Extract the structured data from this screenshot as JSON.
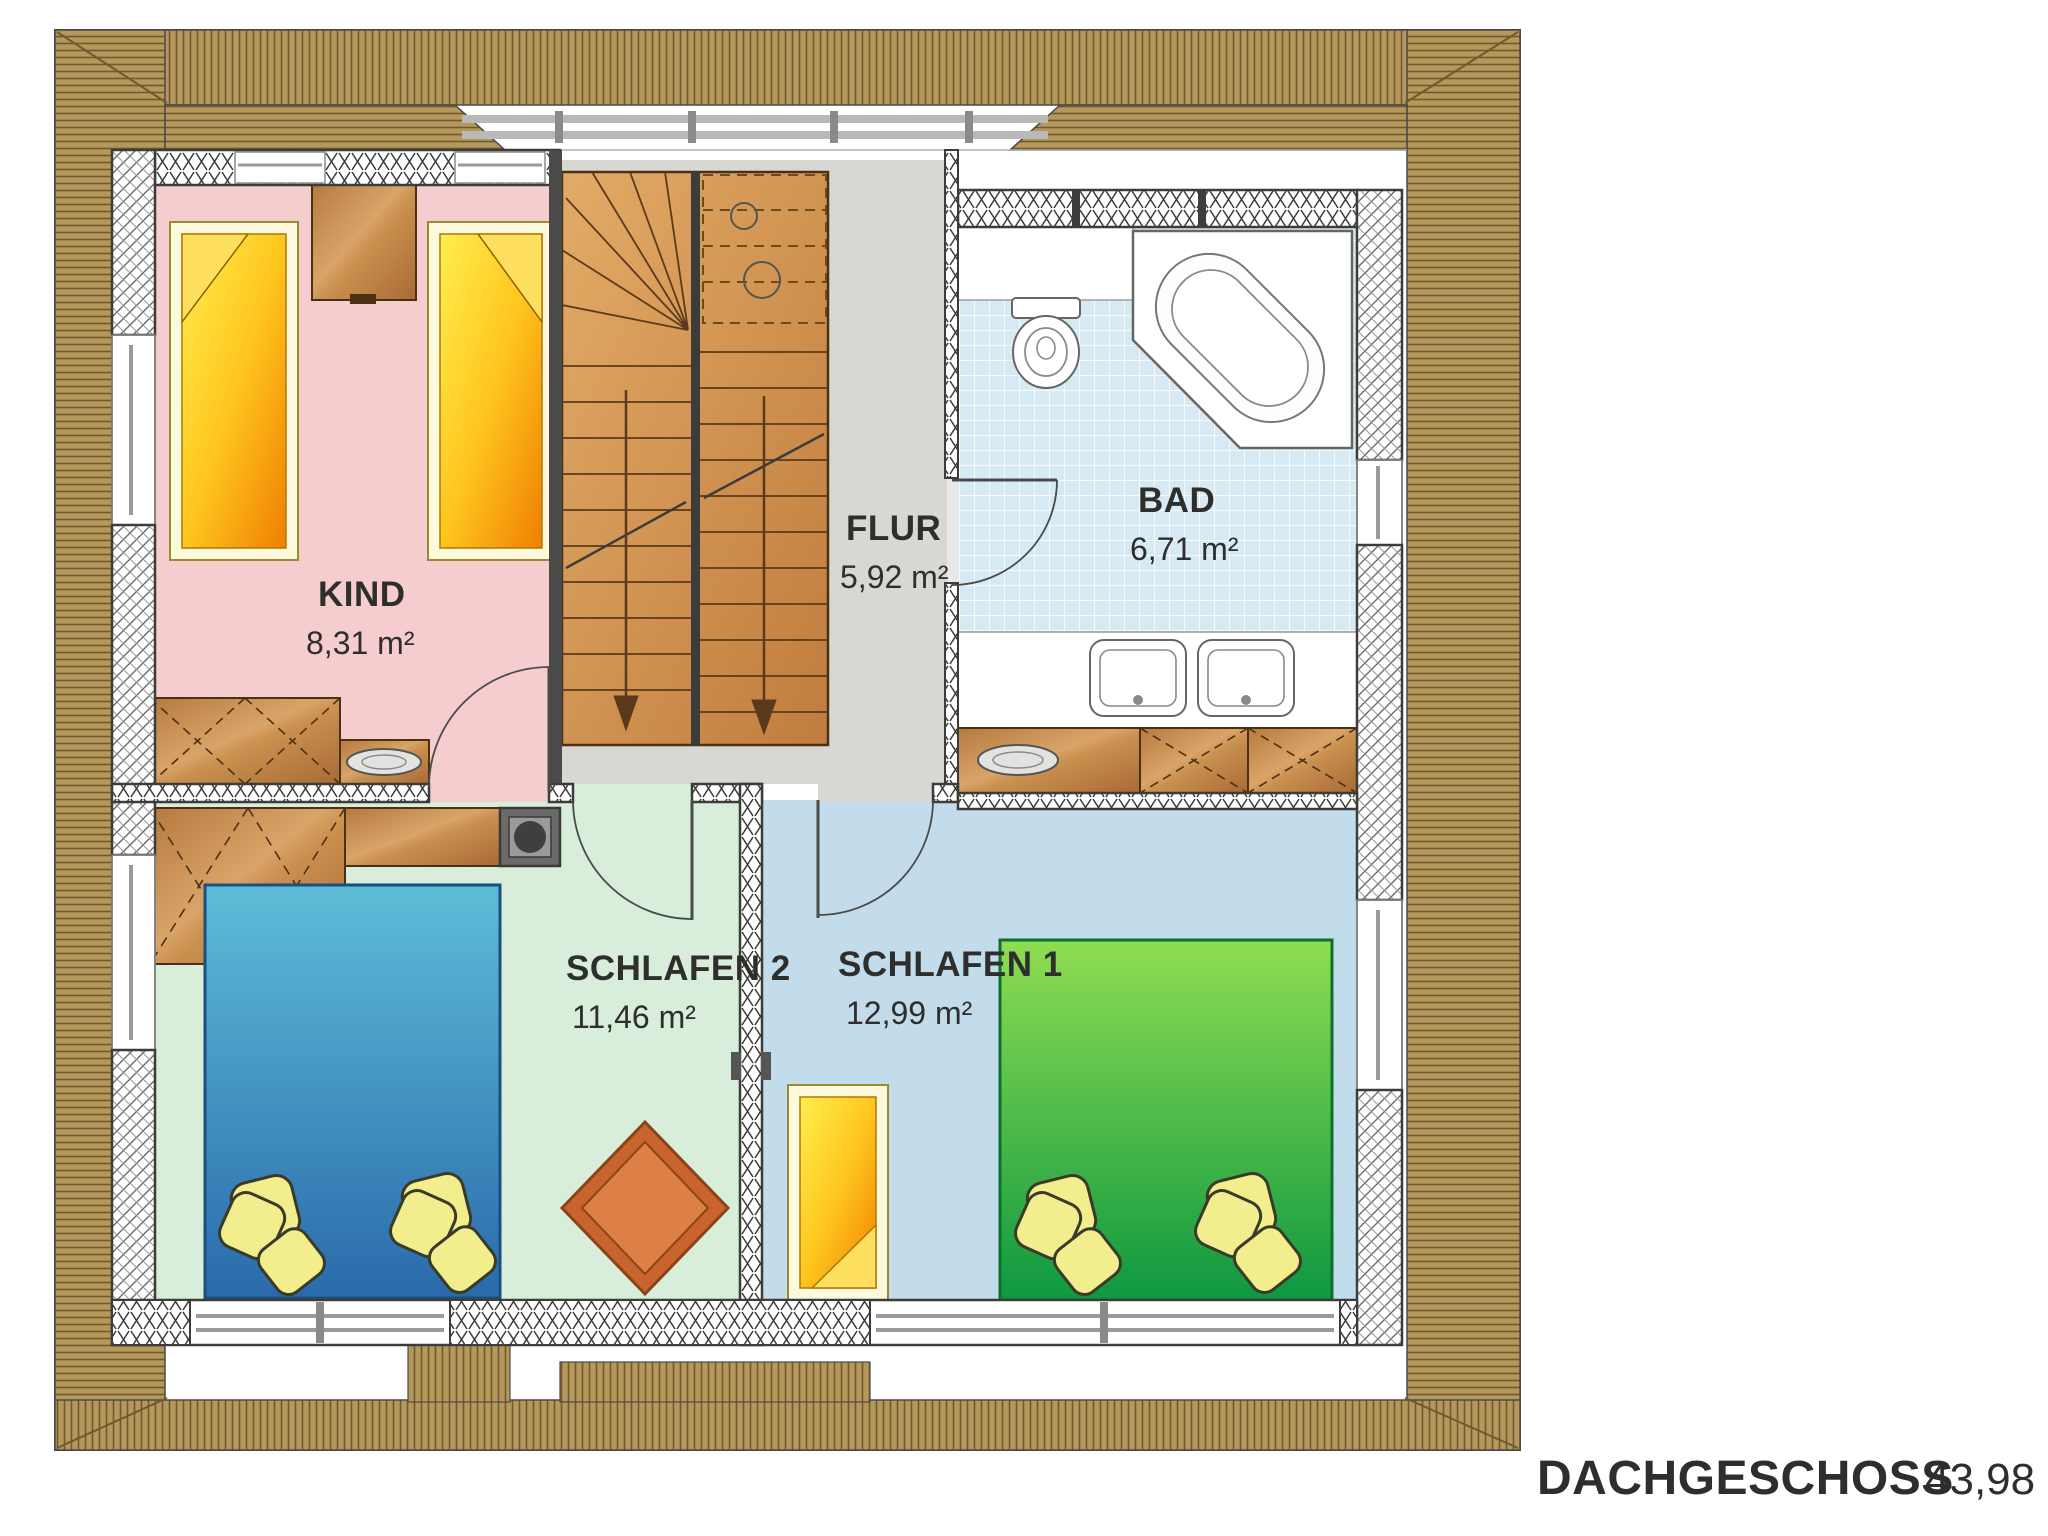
{
  "title": {
    "floor_label": "DACHGESCHOSS",
    "floor_area": "43,98 m²"
  },
  "rooms": [
    {
      "id": "kind",
      "name": "KIND",
      "area": "8,31 m²"
    },
    {
      "id": "flur",
      "name": "FLUR",
      "area": "5,92 m²"
    },
    {
      "id": "bad",
      "name": "BAD",
      "area": "6,71 m²"
    },
    {
      "id": "schlafen2",
      "name": "SCHLAFEN 2",
      "area": "11,46 m²"
    },
    {
      "id": "schlafen1",
      "name": "SCHLAFEN 1",
      "area": "12,99 m²"
    }
  ],
  "colors": {
    "roof": "#b6985c",
    "roof_line": "#6e5a2d",
    "floor_kind": "#f5cdcf",
    "floor_flur": "#d8d7d4",
    "floor_bad": "#d7e9f3",
    "floor_schlafen2": "#d9eddb",
    "floor_schlafen1": "#c3dcec",
    "wood": "#c08a52",
    "stairs": "#d2934f",
    "bed_yellow": "#f7c518",
    "bed_blue": "#3f95c4",
    "bed_green": "#3fbc46",
    "pillow": "#f2ee8e",
    "rug": "#cd6a2f",
    "label": "#2e2e2c"
  }
}
